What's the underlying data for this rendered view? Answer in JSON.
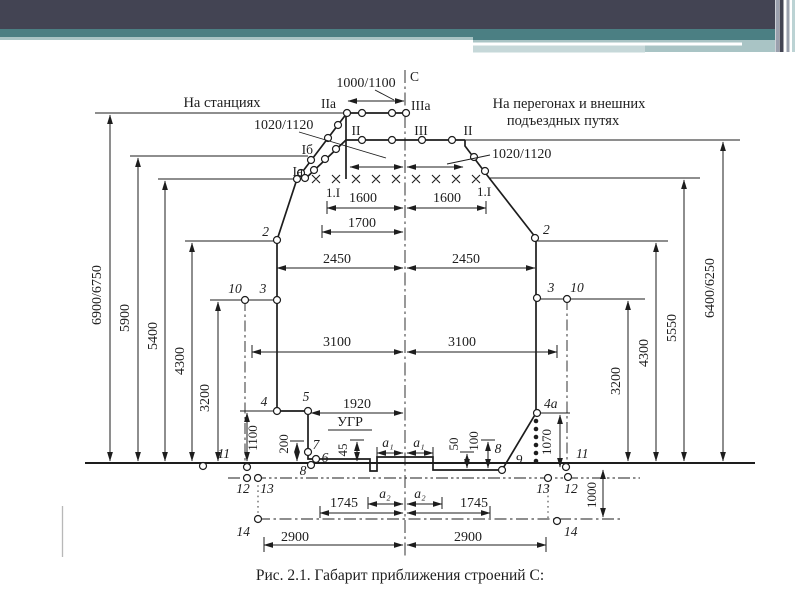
{
  "slide": {
    "header": {
      "bar_dark": "#434453",
      "bar_teal": "#4b7f83",
      "band_light": "#a9c4c5",
      "band_pale": "#c6d8d9",
      "stripe_gray": "#9aa0ad",
      "stripe_pale": "#bcd3d4"
    },
    "caption": "Рис. 2.1.  Габарит приближения строений С:"
  },
  "diagram": {
    "region_left": "На станциях",
    "region_right_line1": "На перегонах и внешних",
    "region_right_line2": "подъездных путях",
    "centerline": "C",
    "profiles": {
      "IIa": "IIа",
      "IIIa": "IIIа",
      "II_left": "II",
      "III": "III",
      "II_right": "II",
      "Ib": "Iб",
      "Ia": "Iа",
      "oneI_left": "1.I",
      "oneI_right": "1.I"
    },
    "widths": {
      "w1000": "1000/1100",
      "w1020_left": "1020/1120",
      "w1020_right": "1020/1120",
      "w1600_left": "1600",
      "w1600_right": "1600",
      "w1700": "1700",
      "w2450_left": "2450",
      "w2450_right": "2450",
      "w3100_left": "3100",
      "w3100_right": "3100",
      "w1920": "1920",
      "w1745_left": "1745",
      "w1745_right": "1745",
      "w2900_left": "2900",
      "w2900_right": "2900",
      "a1_left": "a₁",
      "a1_right": "a₁",
      "a2_left": "a₂",
      "a2_right": "a₂"
    },
    "heights": {
      "h6900": "6900/6750",
      "h5900": "5900",
      "h5400": "5400",
      "h4300_left": "4300",
      "h3200_left": "3200",
      "h3200_right": "3200",
      "h4300_right": "4300",
      "h5550": "5550",
      "h6400": "6400/6250",
      "h1100": "1100",
      "h200": "200",
      "h45": "45",
      "h50": "50",
      "h100": "100",
      "h1070": "1070",
      "h1000": "1000"
    },
    "points": {
      "p2_left": "2",
      "p2_right": "2",
      "p3_left": "3",
      "p3_right": "3",
      "p4": "4",
      "p4a": "4a",
      "p5": "5",
      "p6": "6",
      "p7": "7",
      "p8_left": "8",
      "p8_right": "8",
      "p9": "9",
      "p10_left": "10",
      "p10_right": "10",
      "p11_left": "11",
      "p11_right": "11",
      "p12_left": "12",
      "p12_right": "12",
      "p13_left": "13",
      "p13_right": "13",
      "p14_left": "14",
      "p14_right": "14"
    },
    "ugr": "УГР"
  }
}
